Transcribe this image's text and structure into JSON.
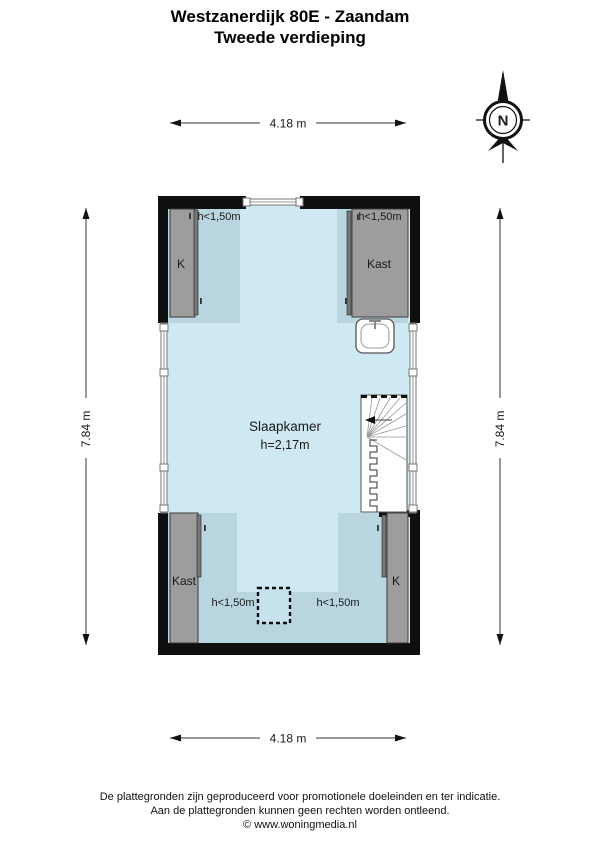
{
  "title": {
    "line1": "Westzanerdijk 80E - Zaandam",
    "line2": "Tweede verdieping"
  },
  "compass": {
    "label": "N"
  },
  "dimensions": {
    "top": "4.18 m",
    "bottom": "4.18 m",
    "left": "7.84 m",
    "right": "7.84 m"
  },
  "rooms": {
    "bedroom": {
      "name": "Slaapkamer",
      "height": "h=2,17m"
    },
    "closet_top_left": "K",
    "closet_top_right": "Kast",
    "closet_bottom_left": "Kast",
    "closet_bottom_right": "K",
    "low_height": "h<1,50m"
  },
  "colors": {
    "floor": "#cfe9f2",
    "floor_low_height": "#b9d6e0",
    "wall": "#0f0f0f",
    "closet": "#9d9d9d"
  },
  "footer": {
    "line1": "De plattegronden zijn geproduceerd voor promotionele doeleinden en ter indicatie.",
    "line2": "Aan de plattegronden kunnen geen rechten worden ontleend.",
    "line3": "© www.woningmedia.nl"
  }
}
